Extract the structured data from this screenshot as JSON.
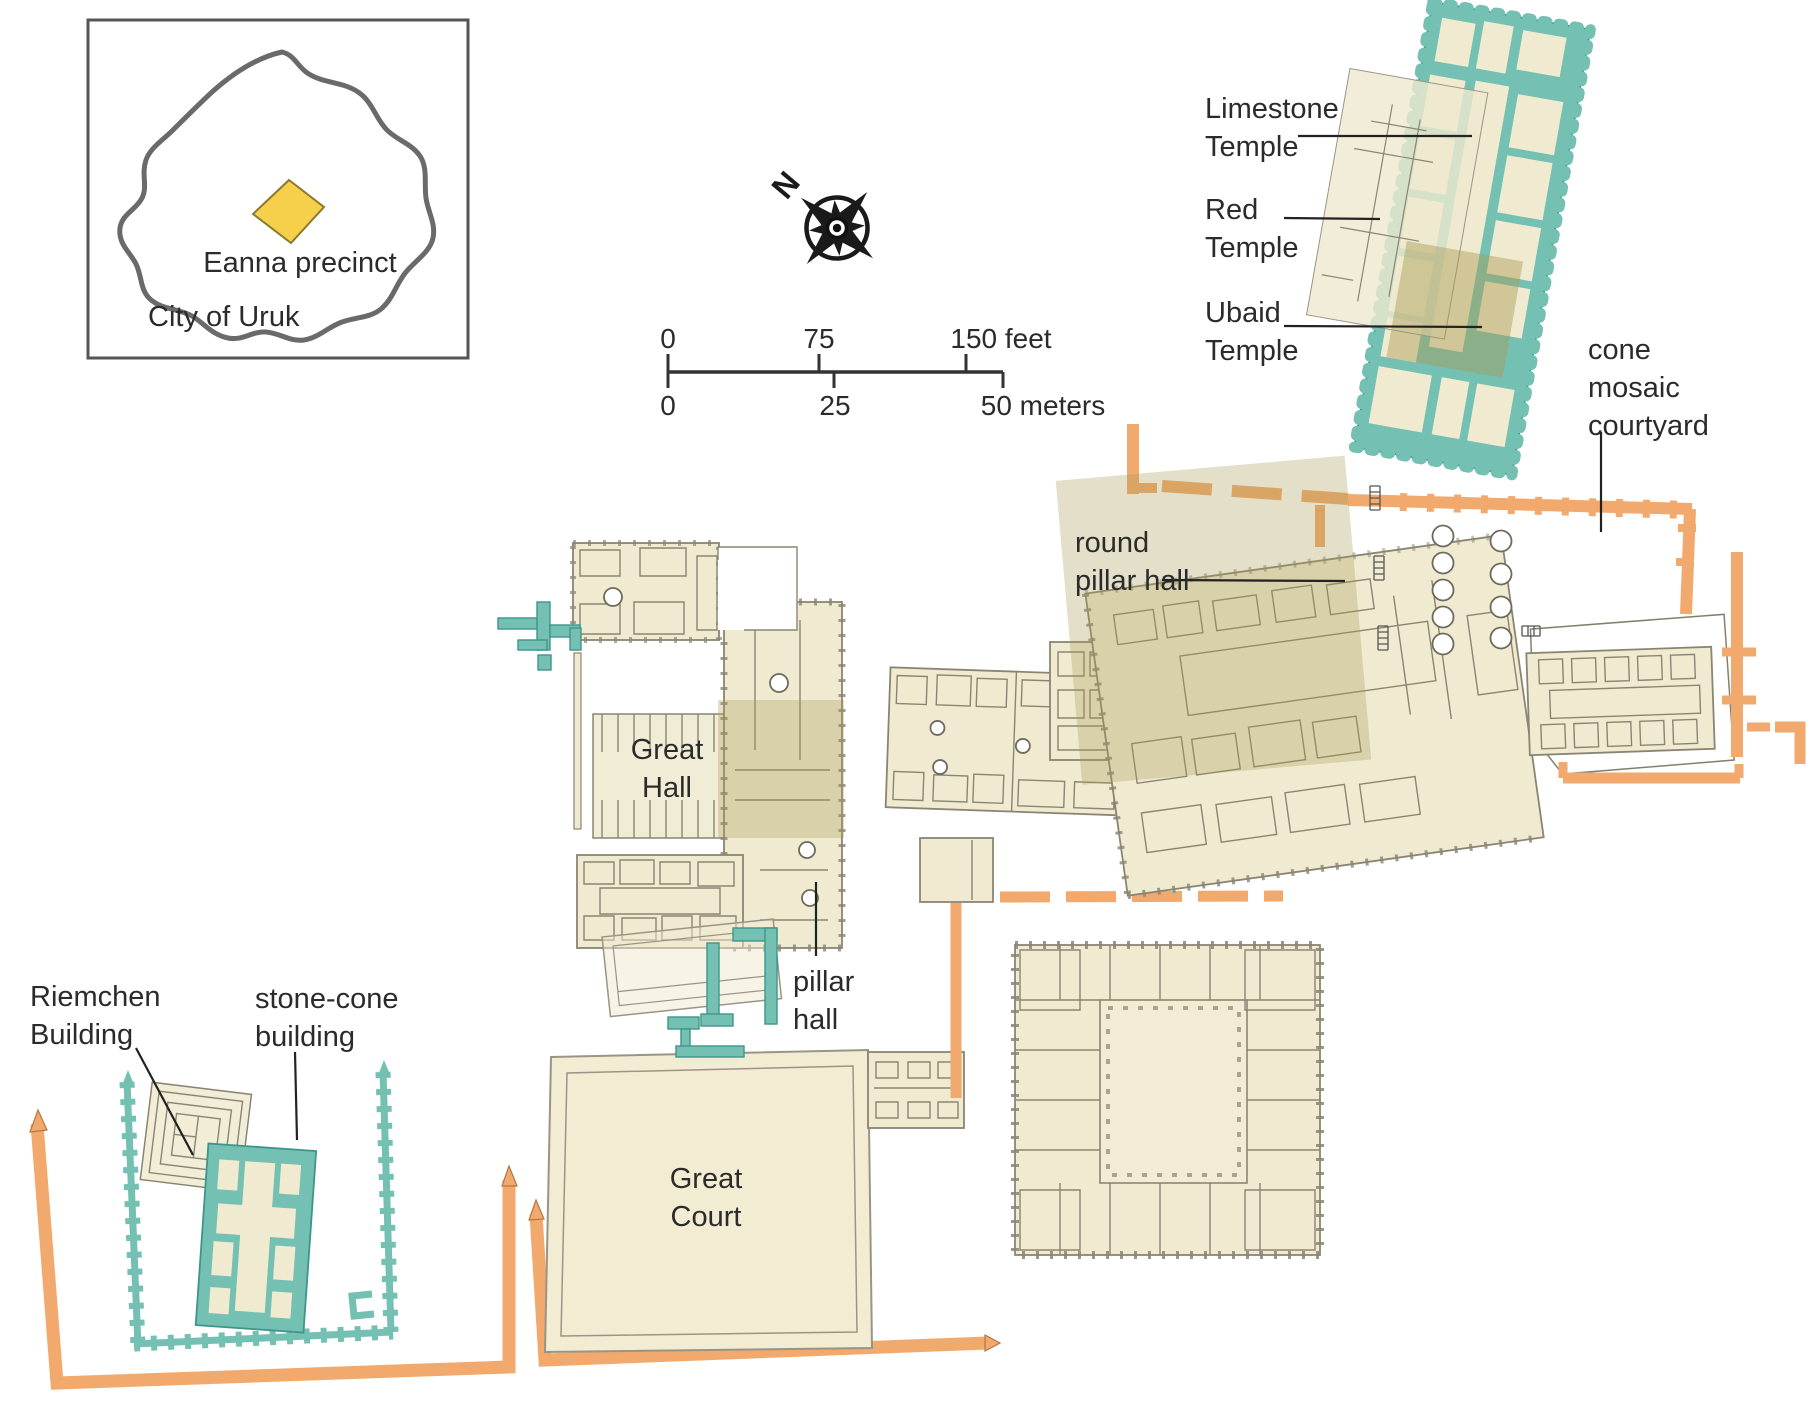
{
  "inset_map": {
    "region_label": "Eanna precinct",
    "city_label": "City of Uruk"
  },
  "compass": {
    "north_label": "N"
  },
  "scale_bar": {
    "feet_zero": "0",
    "feet_mid": "75",
    "feet_end": "150 feet",
    "meters_zero": "0",
    "meters_mid": "25",
    "meters_end": "50 meters"
  },
  "labels": {
    "limestone_temple": {
      "line1": "Limestone",
      "line2": "Temple"
    },
    "red_temple": {
      "line1": "Red",
      "line2": "Temple"
    },
    "ubaid_temple": {
      "line1": "Ubaid",
      "line2": "Temple"
    },
    "cone_mosaic_courtyard": {
      "line1": "cone",
      "line2": "mosaic",
      "line3": "courtyard"
    },
    "round_pillar_hall": {
      "line1": "round",
      "line2": "pillar hall"
    },
    "great_hall": {
      "line1": "Great",
      "line2": "Hall"
    },
    "pillar_hall": {
      "line1": "pillar",
      "line2": "hall"
    },
    "great_court": {
      "line1": "Great",
      "line2": "Court"
    },
    "riemchen_building": {
      "line1": "Riemchen",
      "line2": "Building"
    },
    "stone_cone_building": {
      "line1": "stone-cone",
      "line2": "building"
    }
  },
  "colors": {
    "temple_teal": "#74c0b2",
    "wall_orange": "#f2a96e",
    "building_tan": "#f0ead1",
    "overlay_olive": "#a89c54",
    "precinct_yellow": "#f6d04b",
    "outline_gray": "#8a8573",
    "text_dark": "#2b2b2b"
  }
}
